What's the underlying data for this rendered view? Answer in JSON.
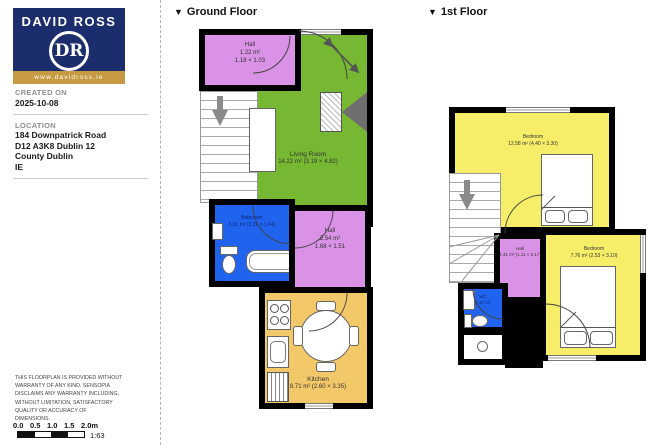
{
  "sidebar": {
    "brand": {
      "name": "DAVID ROSS",
      "monogram": "DR",
      "url": "www.davidross.ie"
    },
    "created": {
      "label": "CREATED ON",
      "value": "2025-10-08"
    },
    "location": {
      "label": "LOCATION",
      "lines": [
        "184 Downpatrick Road",
        "D12 A3K8 Dublin 12",
        "County Dublin",
        "IE"
      ]
    },
    "disclaimer": "THIS FLOORPLAN IS PROVIDED WITHOUT WARRANTY OF ANY KIND. SENSOPIA DISCLAIMS ANY WARRANTY INCLUDING, WITHOUT LIMITATION, SATISFACTORY QUALITY OR ACCURACY OF DIMENSIONS.",
    "scale": {
      "ticks": [
        "0.0",
        "0.5",
        "1.0",
        "1.5",
        "2.0m"
      ],
      "ratio": "1:63"
    }
  },
  "ground_floor": {
    "marker": "▼",
    "title": "Ground Floor",
    "rooms": {
      "hall_entry": {
        "name": "Hall",
        "area": "1.22 m²",
        "dims": "1.18 × 1.03"
      },
      "living_room": {
        "name": "Living Room",
        "area": "14.22 m² (3.19 × 4.82)"
      },
      "bathroom": {
        "name": "Bathroom",
        "area": "3.91 m² (2.39 × 1.64)"
      },
      "hall": {
        "name": "Hall",
        "area": "2.54 m²",
        "dims": "1.68 × 1.51"
      },
      "kitchen": {
        "name": "Kitchen",
        "area": "8.71 m² (2.60 × 3.35)"
      }
    }
  },
  "first_floor": {
    "marker": "▼",
    "title": "1st Floor",
    "rooms": {
      "bedroom_main": {
        "name": "Bedroom",
        "area": "12.58 m² (4.40 × 3.30)"
      },
      "hall": {
        "name": "Hall",
        "area": "2.41 m² (1.11 × 2.17)"
      },
      "bedroom_2": {
        "name": "Bedroom",
        "area": "7.76 m² (2.53 × 3.10)"
      },
      "wc": {
        "name": "WC",
        "area": "1.17 m²"
      }
    }
  },
  "colors": {
    "brand_navy": "#1c2d6e",
    "brand_gold": "#c59a40",
    "living_green": "#76b832",
    "hall_purple": "#da92e6",
    "bathroom_blue": "#2063ee",
    "kitchen_tan": "#f3c869",
    "bedroom_yellow": "#f6ee68",
    "wall_black": "#000000"
  }
}
